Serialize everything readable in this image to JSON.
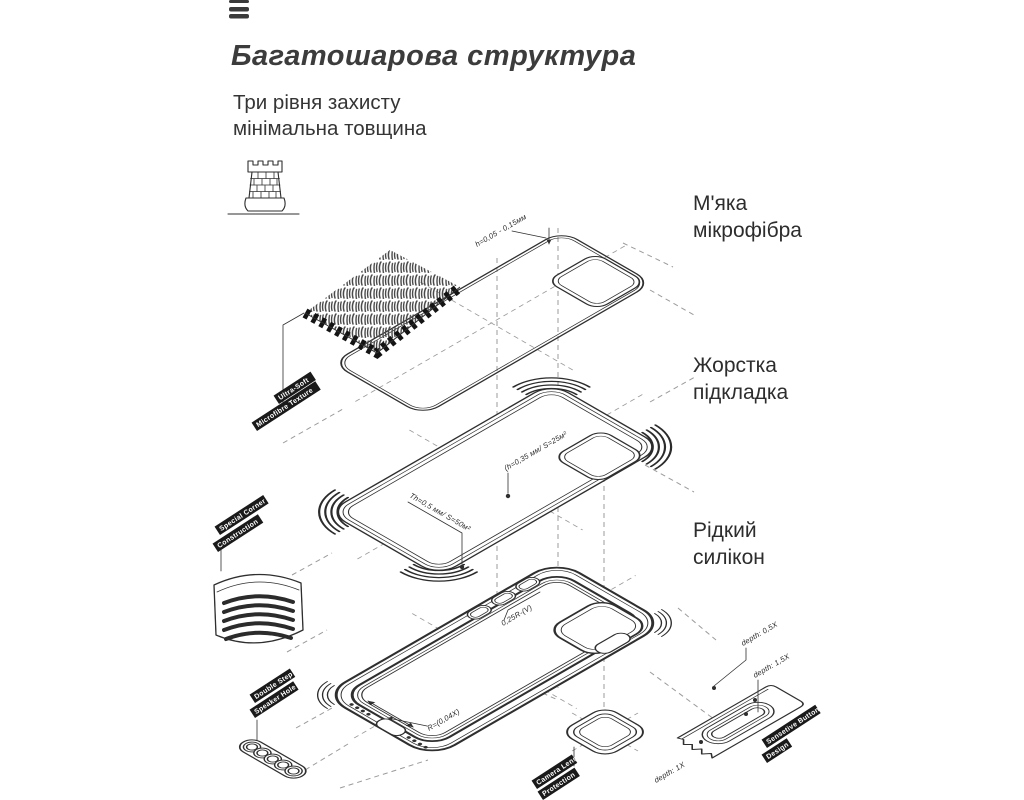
{
  "header": {
    "menu_icon": "three-bars-logo",
    "title": "Багатошарова структура",
    "subtitle_line1": "Три рівня захисту",
    "subtitle_line2": "мінімальна товщина"
  },
  "layer_labels": [
    {
      "line1": "М'яка",
      "line2": "мікрофібра"
    },
    {
      "line1": "Жорстка",
      "line2": "підкладка"
    },
    {
      "line1": "Рідкий",
      "line2": "силікон"
    }
  ],
  "callouts": {
    "microfiber": {
      "line1": "Ultra-Soft",
      "line2": "Microfibre Texture"
    },
    "corner": {
      "line1": "Special Corner",
      "line2": "Construction"
    },
    "speaker": {
      "line1": "Double Step",
      "line2": "Speaker Hole"
    },
    "camera": {
      "line1": "Camera Lens",
      "line2": "Protection"
    },
    "button": {
      "line1": "Sensetive Button",
      "line2": "Design"
    }
  },
  "dimensions": {
    "microfiber_thickness": "h=0,05 - 0,15мм",
    "shell_camera": "(h=0,35 мм/ S=25м²",
    "shell_thickness": "Th=0,5 мм/ S=50м²",
    "button_radius": "0,25R-(V)",
    "case_radius": "R=(0,04X)",
    "depth_small": "depth: 0,5X",
    "depth_large": "depth: 1,5X",
    "depth_mid": "depth: 1X"
  },
  "icons": {
    "tower": "castle-tower-icon"
  },
  "colors": {
    "background": "#ffffff",
    "line": "#2f2f2f",
    "dashed_line": "#9b9b9b",
    "label_bg": "#1a1a1a",
    "label_text": "#ffffff",
    "title_text": "#3c3c3c"
  }
}
